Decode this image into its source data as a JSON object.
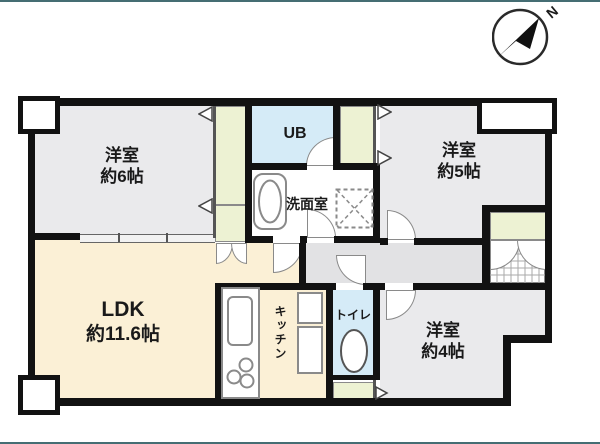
{
  "title": "マンション間取り図",
  "compass": {
    "label": "N"
  },
  "rooms": {
    "bedroom6": {
      "name": "洋室",
      "size": "約6帖"
    },
    "bedroom5": {
      "name": "洋室",
      "size": "約5帖"
    },
    "bedroom4": {
      "name": "洋室",
      "size": "約4帖"
    },
    "ldk": {
      "name": "LDK",
      "size": "約11.6帖"
    },
    "ub": {
      "name": "UB"
    },
    "washroom": {
      "name": "洗面室"
    },
    "kitchen": {
      "name": "キッチン"
    },
    "toilet": {
      "name": "トイレ"
    }
  },
  "colors": {
    "wall": "#121212",
    "floor_gray": "#eaeaec",
    "floor_cream": "#fbf0d6",
    "floor_blue": "#d5ebf7",
    "floor_green": "#edf2d3",
    "hallway": "#e2e2e4",
    "edge": "#456d73"
  }
}
